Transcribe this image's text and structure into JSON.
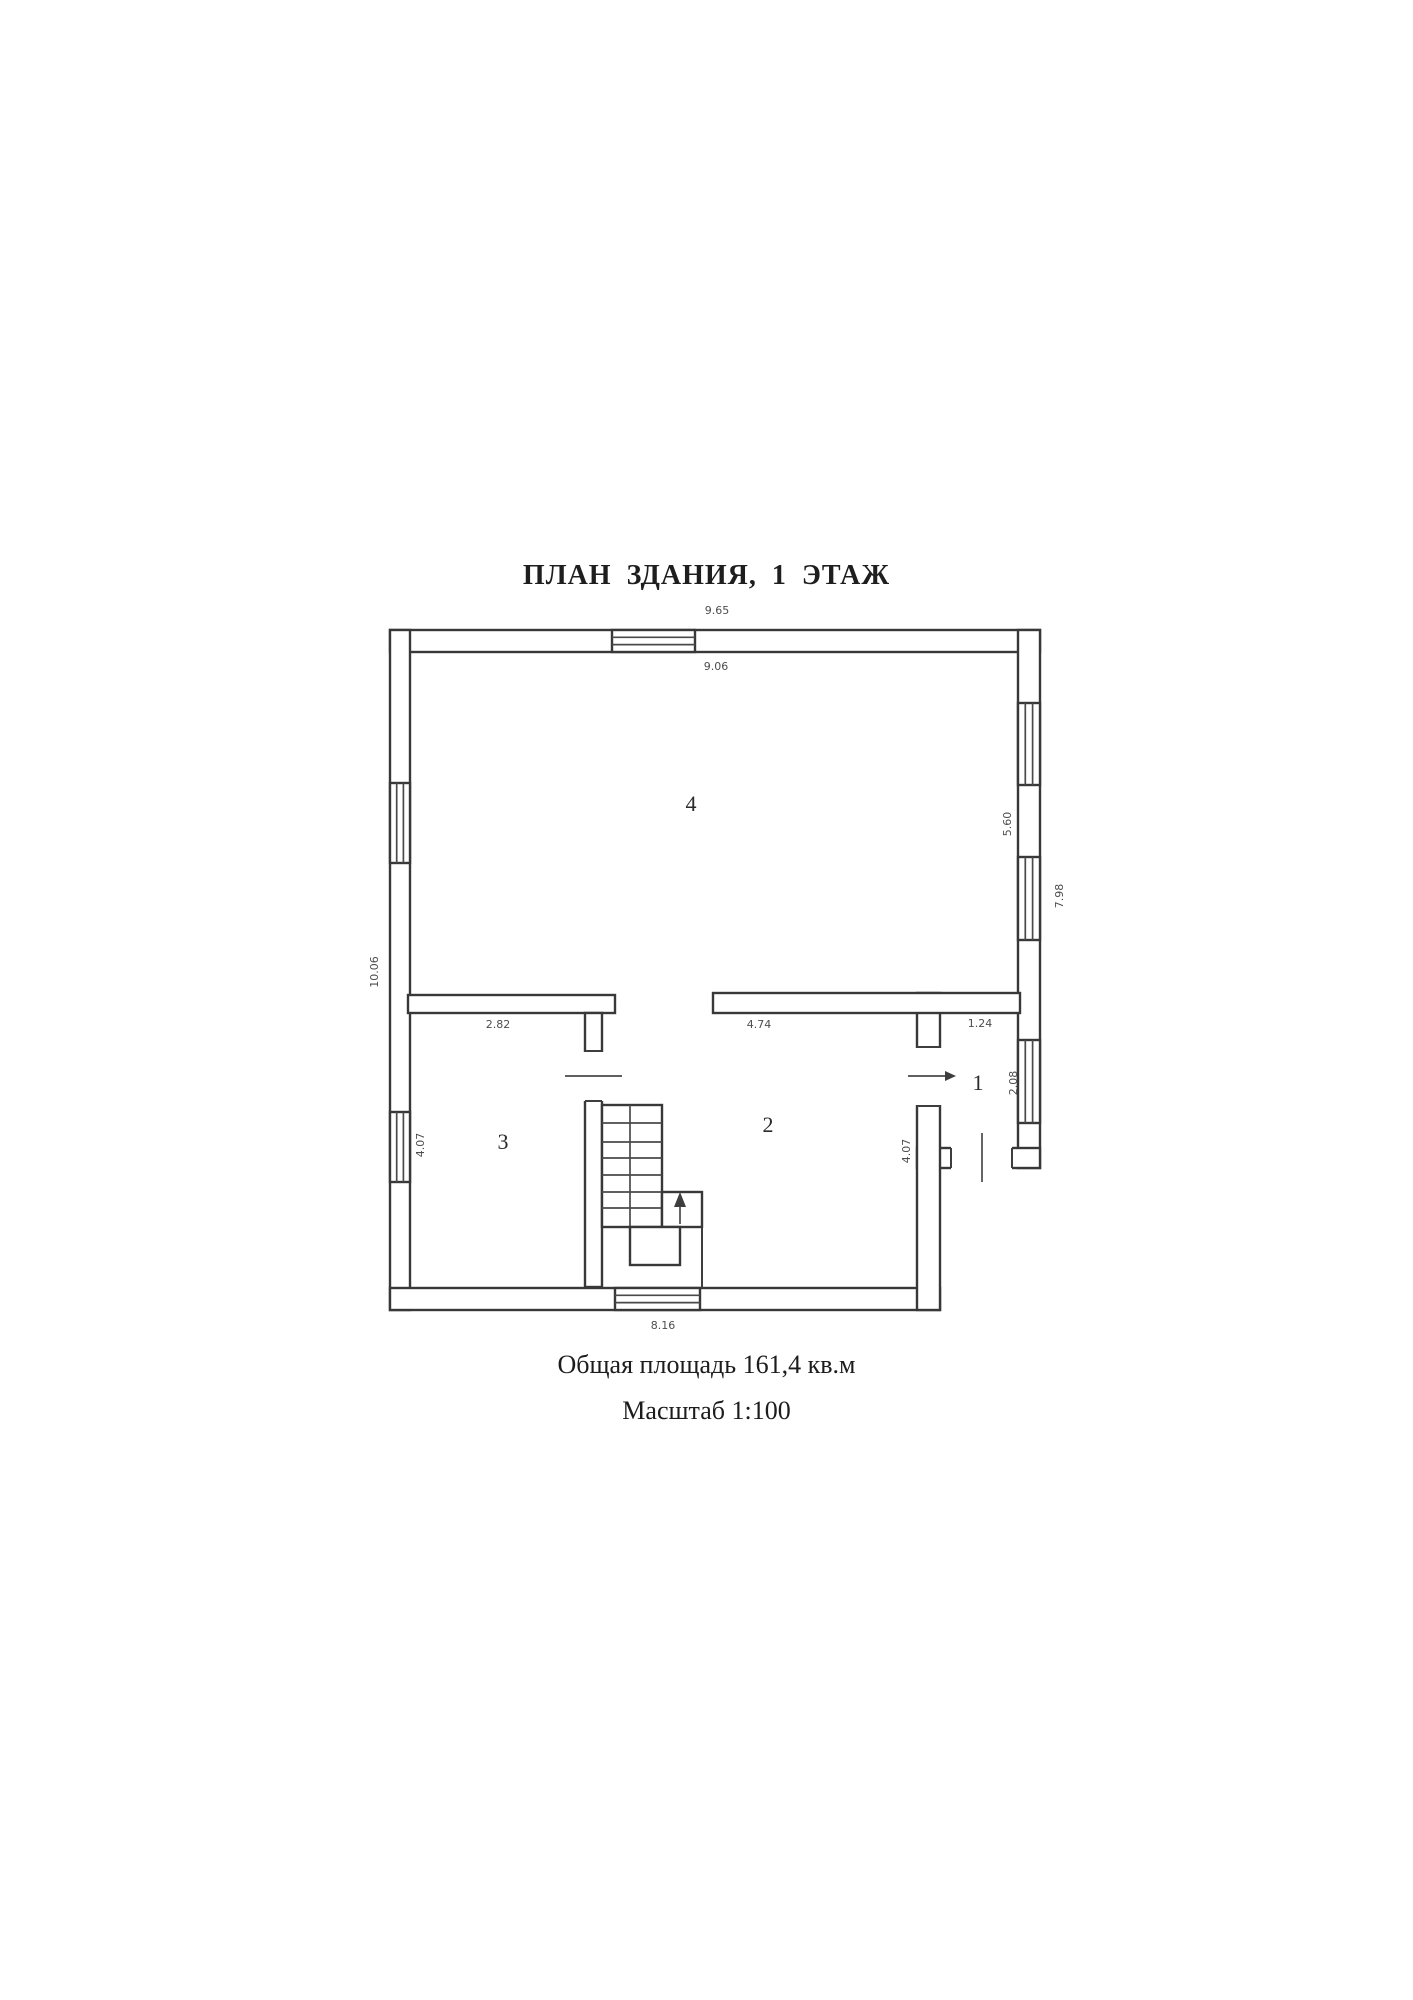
{
  "page": {
    "title": "ПЛАН ЗДАНИЯ, 1 ЭТАЖ",
    "footer": {
      "area": "Общая площадь 161,4 кв.м",
      "scale": "Масштаб 1:100"
    }
  },
  "plan": {
    "rooms": {
      "room1": "1",
      "room2": "2",
      "room3": "3",
      "room4": "4"
    },
    "dimensions": {
      "top_width": "9.65",
      "inner_top_width": "9.06",
      "left_height": "10.06",
      "right_wall_height": "7.98",
      "right_upper_height": "5.60",
      "room3_width": "2.82",
      "room2_width": "4.74",
      "room1_width": "1.24",
      "room1_height": "2.08",
      "room2_height": "4.07",
      "room3_height": "4.07",
      "bottom_width": "8.16"
    }
  }
}
